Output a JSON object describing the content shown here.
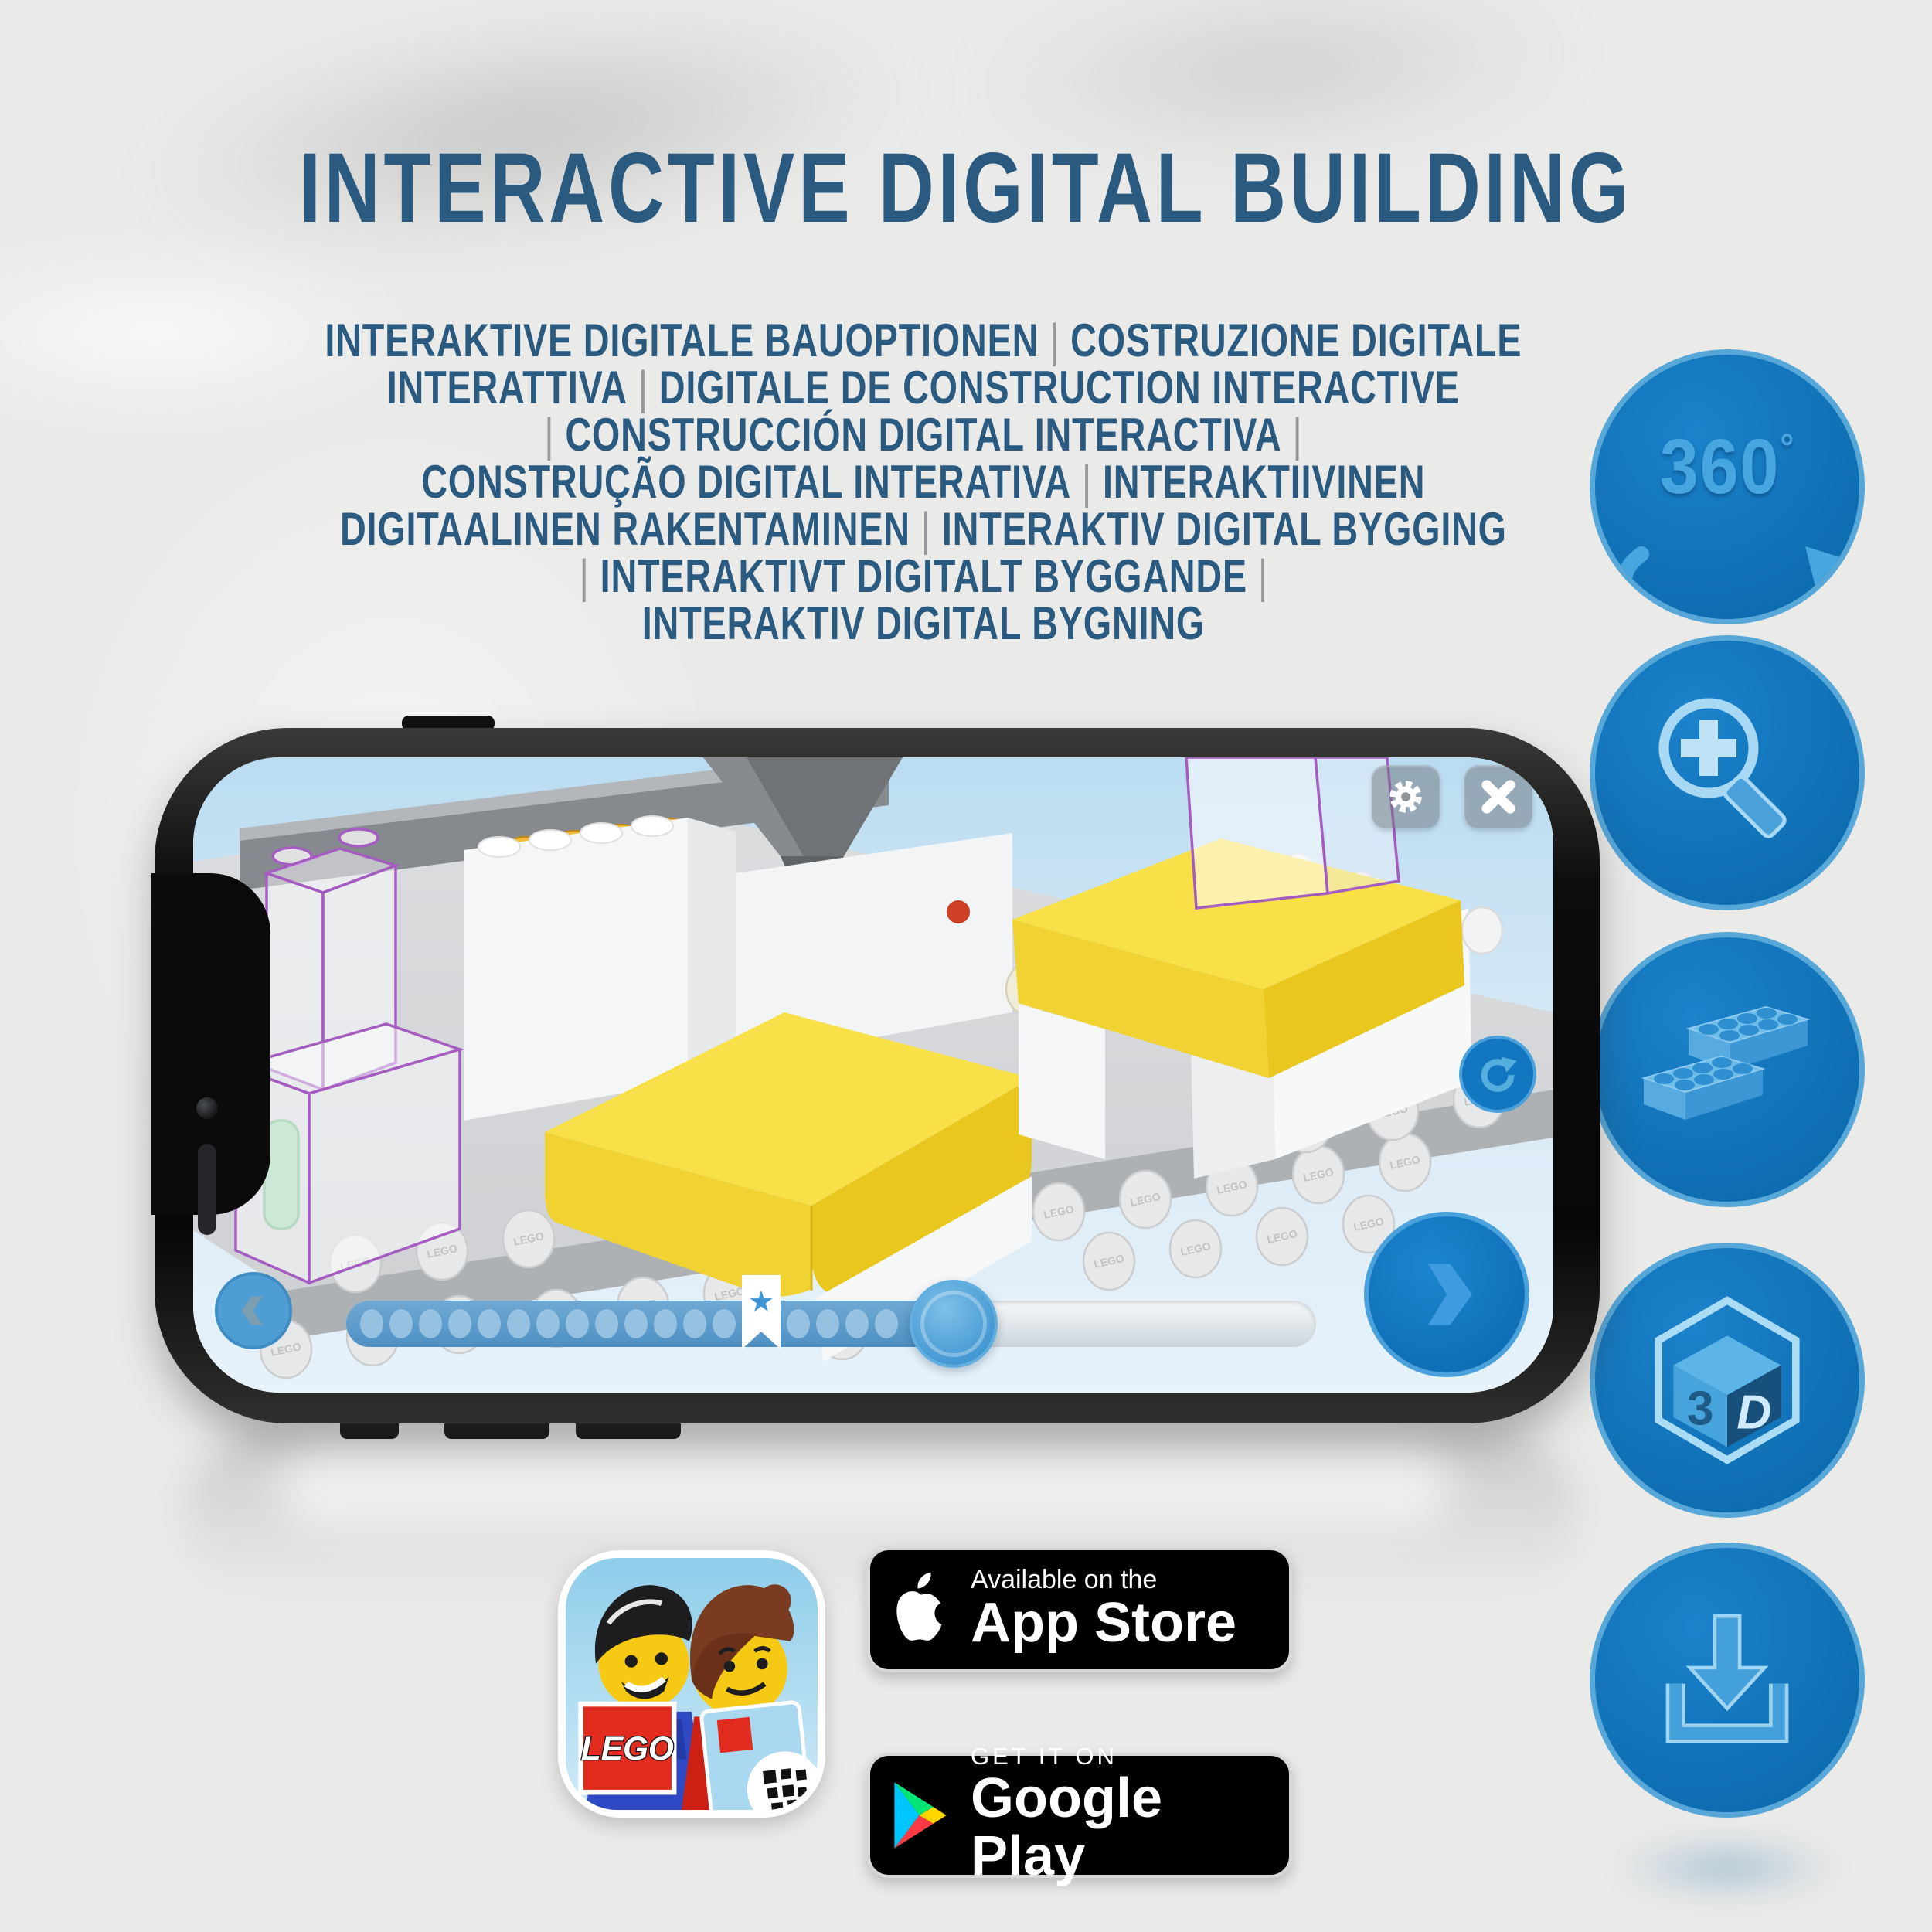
{
  "title": "INTERACTIVE DIGITAL BUILDING",
  "subtitle": {
    "lines": [
      "INTERAKTIVE DIGITALE BAUOPTIONEN | COSTRUZIONE DIGITALE",
      "INTERATTIVA | DIGITALE DE CONSTRUCTION INTERACTIVE",
      "| CONSTRUCCIÓN DIGITAL INTERACTIVA |",
      "CONSTRUÇÃO DIGITAL INTERATIVA | INTERAKTIIVINEN",
      "DIGITAALINEN RAKENTAMINEN | INTERAKTIV DIGITAL BYGGING",
      "| INTERAKTIVT DIGITALT BYGGANDE |",
      "INTERAKTIV DIGITAL BYGNING"
    ]
  },
  "feature_icons": [
    {
      "id": "rotate-360-icon",
      "label": "360",
      "degree": "°"
    },
    {
      "id": "zoom-magnifier-icon"
    },
    {
      "id": "lego-bricks-icon"
    },
    {
      "id": "cube-3d-icon",
      "face_left": "3",
      "face_right": "D"
    },
    {
      "id": "download-icon"
    }
  ],
  "phone": {
    "controls": [
      "settings",
      "close",
      "rotate-reset",
      "next-step",
      "previous-step",
      "build-progress-slider"
    ],
    "slider": {
      "dots_before_star": 13,
      "dots_after_star": 4,
      "star_icon": "★"
    }
  },
  "scene": {
    "stud_embossing": "LEGO"
  },
  "app_icon": {
    "lego_logo": "LEGO"
  },
  "badges": {
    "app_store": {
      "top": "Available on the",
      "bottom": "App Store"
    },
    "google_play": {
      "top": "GET IT ON",
      "bottom": "Google Play"
    }
  },
  "colors": {
    "title_blue": "#2b5a80",
    "pipe_gray": "#95979a",
    "circle_blue": "#0f6fb6",
    "circle_rim": "#57a7d9",
    "icon_blue": "#47a5e0",
    "yellow_brick": "#f8e049",
    "purple_outline": "#a55cc0",
    "screen_bg": "#dcecf7"
  }
}
